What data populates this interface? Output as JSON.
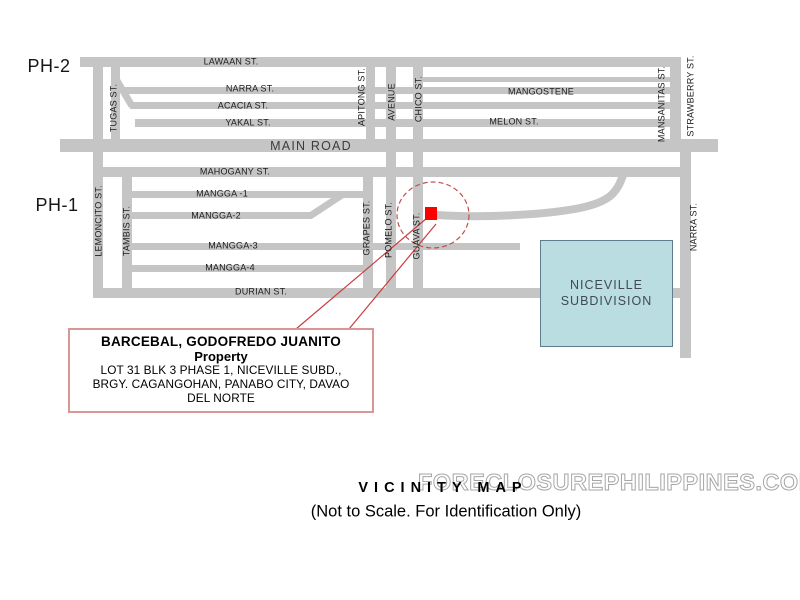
{
  "regions": {
    "ph2": "PH-2",
    "ph1": "PH-1"
  },
  "streets": {
    "lawaan": "LAWAAN ST.",
    "narra_top": "NARRA ST.",
    "acacia": "ACACIA ST.",
    "yakal": "YAKAL ST.",
    "mangostene": "MANGOSTENE",
    "melon": "MELON ST.",
    "main_road": "MAIN ROAD",
    "tugas": "TUGAS ST.",
    "apitong": "APITONG ST.",
    "avenue": "AVENUE",
    "chico": "CHICO ST.",
    "mansanitas": "MANSANITAS ST.",
    "strawberry": "STRAWBERRY ST.",
    "mahogany": "MAHOGANY ST.",
    "mangga1": "MANGGA -1",
    "mangga2": "MANGGA-2",
    "mangga3": "MANGGA-3",
    "mangga4": "MANGGA-4",
    "durian": "DURIAN ST.",
    "lemoncito": "LEMONCITO ST.",
    "tambis": "TAMBIS ST.",
    "grapes": "GRAPES ST.",
    "pomelo": "POMELO ST.",
    "guava": "GUAVA ST.",
    "narra_right": "NARRA ST."
  },
  "areas": {
    "niceville_line1": "NICEVILLE",
    "niceville_line2": "SUBDIVISION"
  },
  "callout": {
    "title_line1": "BARCEBAL, GODOFREDO JUANITO",
    "title_line2": "Property",
    "address_line1": "LOT 31 BLK 3 PHASE 1, NICEVILLE SUBD.,",
    "address_line2": "BRGY. CAGANGOHAN, PANABO CITY, DAVAO",
    "address_line3": "DEL NORTE"
  },
  "footer": {
    "watermark": "FORECLOSUREPHILIPPINES.COM",
    "title": "VICINITY MAP",
    "subtitle": "(Not to Scale. For Identification Only)"
  },
  "colors": {
    "road": "#c5c5c5",
    "marker_red": "#fe0000",
    "annotation_red": "#c0504d",
    "leader": "#cb3d3d",
    "callout_border": "#d99694",
    "niceville_fill": "#badde2",
    "niceville_border": "#5f7d8a"
  }
}
